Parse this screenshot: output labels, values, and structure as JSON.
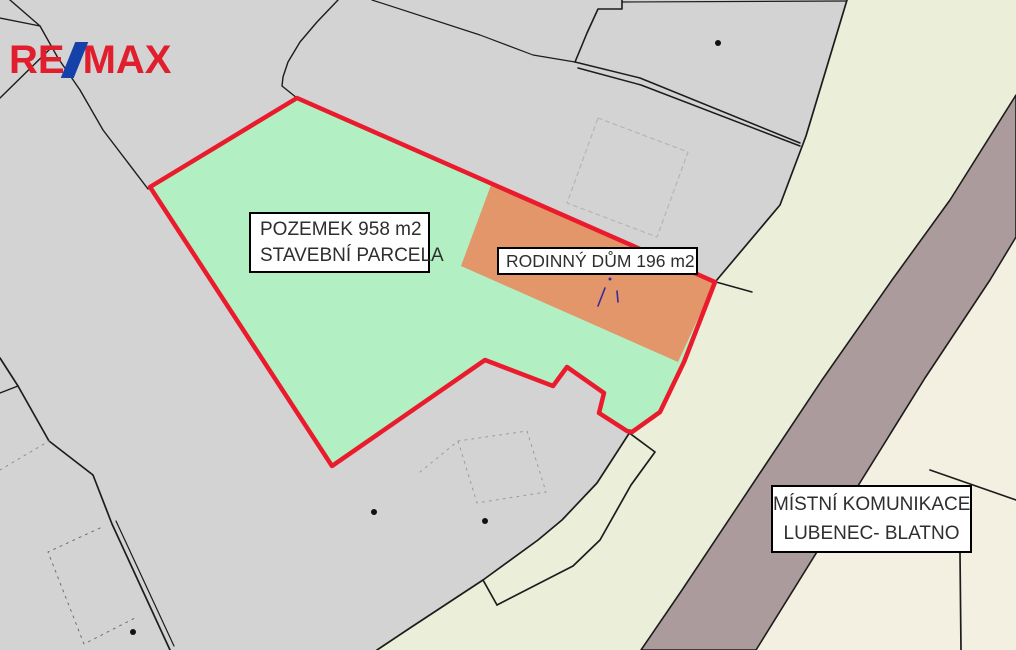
{
  "branding": {
    "logo_re": "RE",
    "logo_max": "MAX",
    "logo_slash_icon": "diagonal-slash",
    "logo_red": "#e11e2d",
    "logo_blue": "#1442aa"
  },
  "labels": {
    "parcel": {
      "line1": "POZEMEK 958 m2",
      "line2": "STAVEBNÍ PARCELA"
    },
    "house": {
      "line1": "RODINNÝ DŮM 196 m2"
    },
    "road": {
      "line1": "MÍSTNÍ KOMUNIKACE",
      "line2": "LUBENEC- BLATNO"
    }
  },
  "map": {
    "colors": {
      "base_gray": "#d3d3d3",
      "verge_cream": "#ebeed8",
      "far_parcel_cream": "#f3f0e2",
      "road_mauve": "#ac9b9d",
      "plot_green": "#b2f0c4",
      "building_orange": "#e2966a",
      "highlight_red": "#ea1b2d",
      "boundary_black": "#1c1c1c"
    },
    "shapes": [
      {
        "name": "base-gray",
        "type": "polygon",
        "points": "0,0 1016,0 1016,650 0,650",
        "fill": "#d3d3d3"
      },
      {
        "name": "road-verge-area",
        "type": "polygon",
        "points": "847,0 1016,0 1016,650 377,650 410,628 483,580 538,540 562,520 597,483 630,432 660,412 684,362 716,281 780,205 806,136",
        "fill": "#ebeed8"
      },
      {
        "name": "parcel-right-of-road",
        "type": "polygon",
        "points": "1016,237 990,280 925,378 756,650 1016,650",
        "fill": "#f3f0e2"
      },
      {
        "name": "road-stripe",
        "type": "polygon",
        "points": "1016,95 1016,237 990,280 925,378 756,650 641,650 680,593 822,380 892,280 950,200",
        "fill": "#ac9b9d",
        "stroke": "#1c1c1c",
        "width": 1.6
      },
      {
        "name": "boundary-gray-cream-top",
        "type": "polyline",
        "points": "847,0 806,136 780,205 716,281",
        "stroke": "#1c1c1c",
        "width": 1.7
      },
      {
        "name": "boundary-gray-cream-bottom",
        "type": "polyline",
        "points": "630,432 597,483 562,520 538,540 483,580 410,628 377,650",
        "stroke": "#1c1c1c",
        "width": 1.7
      },
      {
        "name": "strip-parcel-line",
        "type": "polyline",
        "points": "628,432 655,452 631,485 600,540 573,566 497,605",
        "stroke": "#1c1c1c",
        "width": 1.7
      },
      {
        "name": "strip-parcel-close",
        "type": "polyline",
        "points": "483,580 497,605",
        "stroke": "#1c1c1c",
        "width": 1.7
      },
      {
        "name": "corner-stub-line",
        "type": "polyline",
        "points": "716,282 752,292",
        "stroke": "#1c1c1c",
        "width": 1.5
      },
      {
        "name": "right-parcel-line",
        "type": "polyline",
        "points": "930,470 1016,500",
        "stroke": "#1c1c1c",
        "width": 1.7
      },
      {
        "name": "right-parcel-vline",
        "type": "polyline",
        "points": "960,512 960,553 961,650",
        "stroke": "#1c1c1c",
        "width": 1.7
      },
      {
        "name": "line-topleft-a",
        "type": "polyline",
        "points": "10,0 40,26 58,58 80,90 103,130 148,189",
        "stroke": "#1c1c1c",
        "width": 1.4
      },
      {
        "name": "line-topleft-b",
        "type": "polyline",
        "points": "0,18 40,26",
        "stroke": "#1c1c1c",
        "width": 1.4
      },
      {
        "name": "line-topleft-c",
        "type": "polyline",
        "points": "0,98 53,46",
        "stroke": "#1c1c1c",
        "width": 1.4
      },
      {
        "name": "line-to-green-apex",
        "type": "polyline",
        "points": "338,0 317,22 300,42 288,62 283,77 282,86 297,98",
        "stroke": "#1c1c1c",
        "width": 1.4
      },
      {
        "name": "line-top-gentle",
        "type": "polyline",
        "points": "372,0 480,35 533,55 575,62",
        "stroke": "#1c1c1c",
        "width": 1.2
      },
      {
        "name": "line-top-parcel-left",
        "type": "polyline",
        "points": "622,0 622,9 598,9 587,33 580,50 575,62",
        "stroke": "#1c1c1c",
        "width": 1.6
      },
      {
        "name": "path-upper-line",
        "type": "polyline",
        "points": "575,62 640,78 800,143",
        "stroke": "#1c1c1c",
        "width": 1.5
      },
      {
        "name": "path-lower-line",
        "type": "polyline",
        "points": "578,68 641,85 800,146",
        "stroke": "#1c1c1c",
        "width": 1.5
      },
      {
        "name": "line-top-edge",
        "type": "polyline",
        "points": "622,2 847,1",
        "stroke": "#1c1c1c",
        "width": 1.2
      },
      {
        "name": "line-bottomleft-main",
        "type": "polyline",
        "points": "0,358 18,386 49,441 93,475 112,524 170,650",
        "stroke": "#1c1c1c",
        "width": 1.7
      },
      {
        "name": "line-bottomleft-branch",
        "type": "polyline",
        "points": "0,393 18,386",
        "stroke": "#1c1c1c",
        "width": 1.4
      },
      {
        "name": "line-bottomleft-parallel",
        "type": "polyline",
        "points": "116,521 174,646",
        "stroke": "#1c1c1c",
        "width": 1.2
      },
      {
        "name": "dash-line-left",
        "type": "polyline",
        "points": "0,470 49,441",
        "stroke": "#8f8f8f",
        "width": 1,
        "dash": "2,5"
      },
      {
        "name": "dash-building-bottomleft",
        "type": "polyline",
        "points": "100,528 48,552 84,644 135,618",
        "stroke": "#6f6f6f",
        "width": 1,
        "dash": "2,5"
      },
      {
        "name": "dash-building-center",
        "type": "polygon",
        "points": "458,441 527,431 546,492 477,503",
        "stroke": "#9a9a9a",
        "width": 1,
        "dash": "2,5"
      },
      {
        "name": "dash-building-center-ext",
        "type": "polyline",
        "points": "420,472 458,441",
        "stroke": "#9a9a9a",
        "width": 1,
        "dash": "2,5"
      },
      {
        "name": "dash-building-top",
        "type": "polygon",
        "points": "598,118 688,152 657,237 567,203",
        "stroke": "#b5b5b5",
        "width": 1.2,
        "dash": "4,4"
      },
      {
        "name": "plot-green",
        "type": "polygon",
        "points": "297,98 715,282 684,362 660,412 632,432 627,431 599,413 604,393 567,367 553,386 485,360 332,466 150,187",
        "fill": "#b2f0c4"
      },
      {
        "name": "building-orange",
        "type": "polygon",
        "points": "491,185 715,282 678,362 461,266",
        "fill": "#e2966a"
      },
      {
        "name": "plot-red-outline",
        "type": "polygon",
        "points": "297,98 715,282 684,362 660,412 632,432 627,431 599,413 604,393 567,367 553,386 485,360 332,466 150,187",
        "fill": "none",
        "stroke": "#ea1b2d",
        "width": 4.5
      },
      {
        "name": "building-use-mark-slash",
        "type": "polyline",
        "points": "598,306 605,288",
        "stroke": "#3a2b9b",
        "width": 1.6
      },
      {
        "name": "building-use-mark-stroke",
        "type": "polyline",
        "points": "617,291 618,302",
        "stroke": "#3a2b9b",
        "width": 1.6
      },
      {
        "name": "building-use-mark-dot",
        "type": "dot",
        "x": 610,
        "y": 279,
        "r": 1.5,
        "fill": "#3a2b9b"
      },
      {
        "name": "building-dot-top",
        "type": "dot",
        "x": 718,
        "y": 43,
        "r": 3,
        "fill": "#111111"
      },
      {
        "name": "building-dot-left",
        "type": "dot",
        "x": 374,
        "y": 512,
        "r": 3,
        "fill": "#111111"
      },
      {
        "name": "building-dot-mid",
        "type": "dot",
        "x": 485,
        "y": 521,
        "r": 3,
        "fill": "#111111"
      },
      {
        "name": "building-dot-bottomleft",
        "type": "dot",
        "x": 133,
        "y": 632,
        "r": 3,
        "fill": "#111111"
      }
    ]
  }
}
